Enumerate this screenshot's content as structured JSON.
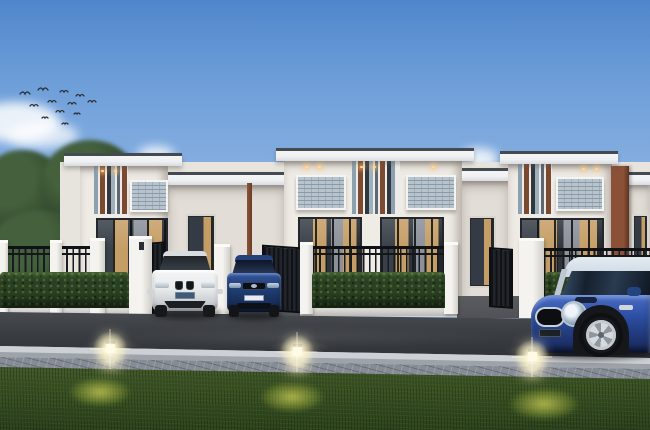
{
  "scene": {
    "type": "architectural-exterior-render",
    "time_of_day": "dusk",
    "subject": "Row of modern single-storey townhouses with striped accent facades, black metal fences, hedges, parked cars, street and lawn with glowing bollard lights",
    "birds_count": 12
  },
  "colors": {
    "sky_top": "#4f86cc",
    "sky_horizon": "#e3edf8",
    "facade": "#efebe5",
    "facade_shade": "#e2ddd6",
    "roof_dark": "#454a51",
    "fascia": "#eef0f2",
    "stripe_rust": "#7c4a31",
    "stripe_charcoal": "#31373e",
    "stripe_steel": "#9fb0bd",
    "window_glass": "#b7c4cd",
    "curtain_tan": "#c59e66",
    "door_dark": "#23262b",
    "fence_iron": "#0f1115",
    "pillar_white": "#e9e8e4",
    "hedge_green": "#2b4023",
    "apron_concrete": "#505257",
    "road_asphalt": "#3a3d42",
    "curb_light": "#cdd0d4",
    "paver_gray": "#868c96",
    "lawn_green": "#3a5124",
    "light_warm": "#fff7d8",
    "tree_green": "#31492e",
    "car_white": "#e9ebec",
    "car_navy": "#1d3a6b",
    "mini_blue": "#2b4c9f",
    "mini_roof": "#cdd8e2",
    "plate_blue": "#3f5a77"
  },
  "objects": {
    "houses": [
      {
        "label": "townhouse-unit-left"
      },
      {
        "label": "townhouse-unit-middle-pair"
      },
      {
        "label": "townhouse-unit-right"
      }
    ],
    "cars": [
      {
        "label": "white-coupe-in-driveway",
        "color": "white"
      },
      {
        "label": "navy-crossover-in-driveway",
        "color": "dark blue"
      },
      {
        "label": "blue-mini-hatchback-on-street",
        "color": "royal blue, silver roof"
      }
    ],
    "lights": [
      {
        "label": "lawn-bollard-light-1"
      },
      {
        "label": "lawn-bollard-light-2"
      },
      {
        "label": "lawn-bollard-light-3"
      }
    ]
  }
}
